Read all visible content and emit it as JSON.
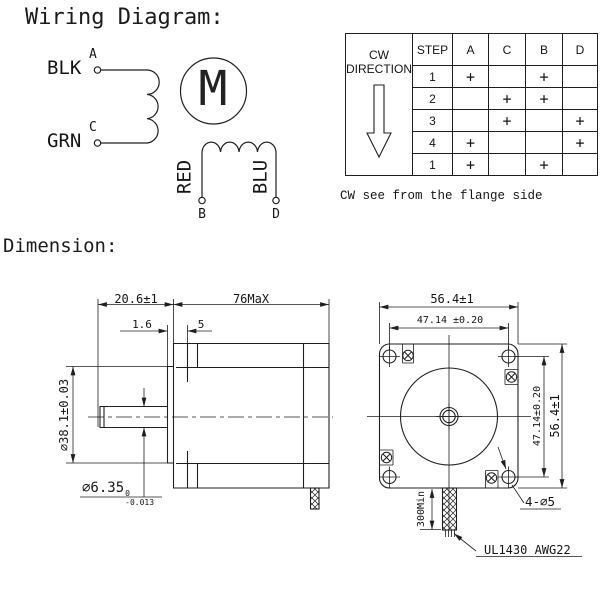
{
  "wiring": {
    "title": "Wiring Diagram:",
    "motor_symbol": "M",
    "wires": {
      "black": "BLK",
      "green": "GRN",
      "red": "RED",
      "blue": "BLU"
    },
    "terminals": {
      "a": "A",
      "c": "C",
      "b": "B",
      "d": "D"
    }
  },
  "step_table": {
    "direction_header_line1": "CW",
    "direction_header_line2": "DIRECTION",
    "headers": [
      "STEP",
      "A",
      "C",
      "B",
      "D"
    ],
    "rows": [
      [
        "1",
        "+",
        "",
        "+",
        ""
      ],
      [
        "2",
        "",
        "+",
        "+",
        ""
      ],
      [
        "3",
        "",
        "+",
        "",
        "+"
      ],
      [
        "4",
        "+",
        "",
        "",
        "+"
      ],
      [
        "1",
        "+",
        "",
        "+",
        ""
      ]
    ],
    "caption": "CW see from the flange side"
  },
  "dimensions": {
    "title": "Dimension:",
    "side_view": {
      "shaft_length": "20.6±1",
      "body_length": "76MaX",
      "boss_protrusion": "1.6",
      "flange_thickness": "5",
      "boss_diameter": "⌀38.1±0.03",
      "shaft_diameter": "⌀6.35",
      "shaft_tol_upper": "0",
      "shaft_tol_lower": "-0.013"
    },
    "front_view": {
      "width": "56.4±1",
      "hole_spacing_h": "47.14 ±0.20",
      "hole_spacing_v": "47.14±0.20",
      "height": "56.4±1",
      "mount_holes": "4-⌀5",
      "cable_min_length": "300Min",
      "cable_spec": "UL1430 AWG22"
    }
  }
}
